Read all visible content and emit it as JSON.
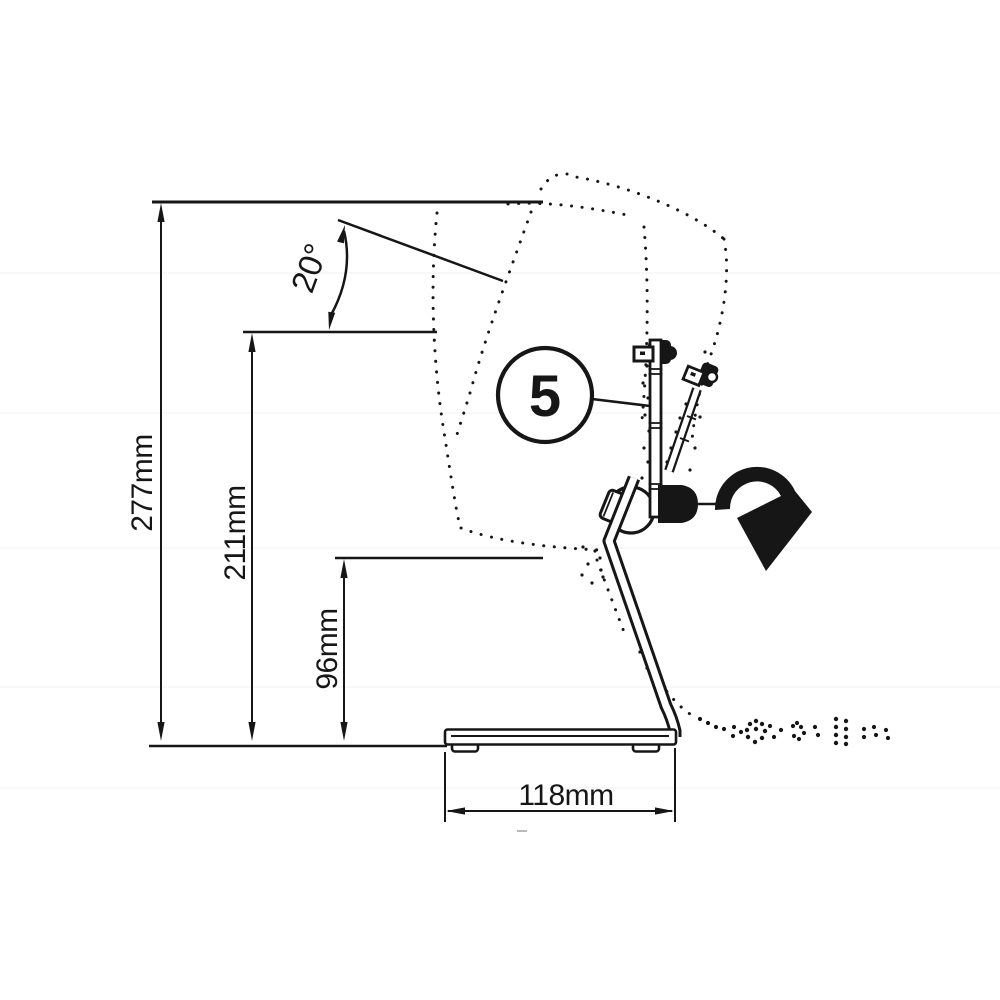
{
  "drawing": {
    "type": "technical-dimension-diagram",
    "subject": "tilting desktop stand side view with tilt ghost outline",
    "ink_color": "#161616",
    "background_color": "#ffffff",
    "dimensions": {
      "total_height_label": "277mm",
      "upper_height_label": "211mm",
      "pivot_height_label": "96mm",
      "base_width_label": "118mm",
      "tilt_angle_label": "20°"
    },
    "callout": {
      "number": "5"
    }
  }
}
